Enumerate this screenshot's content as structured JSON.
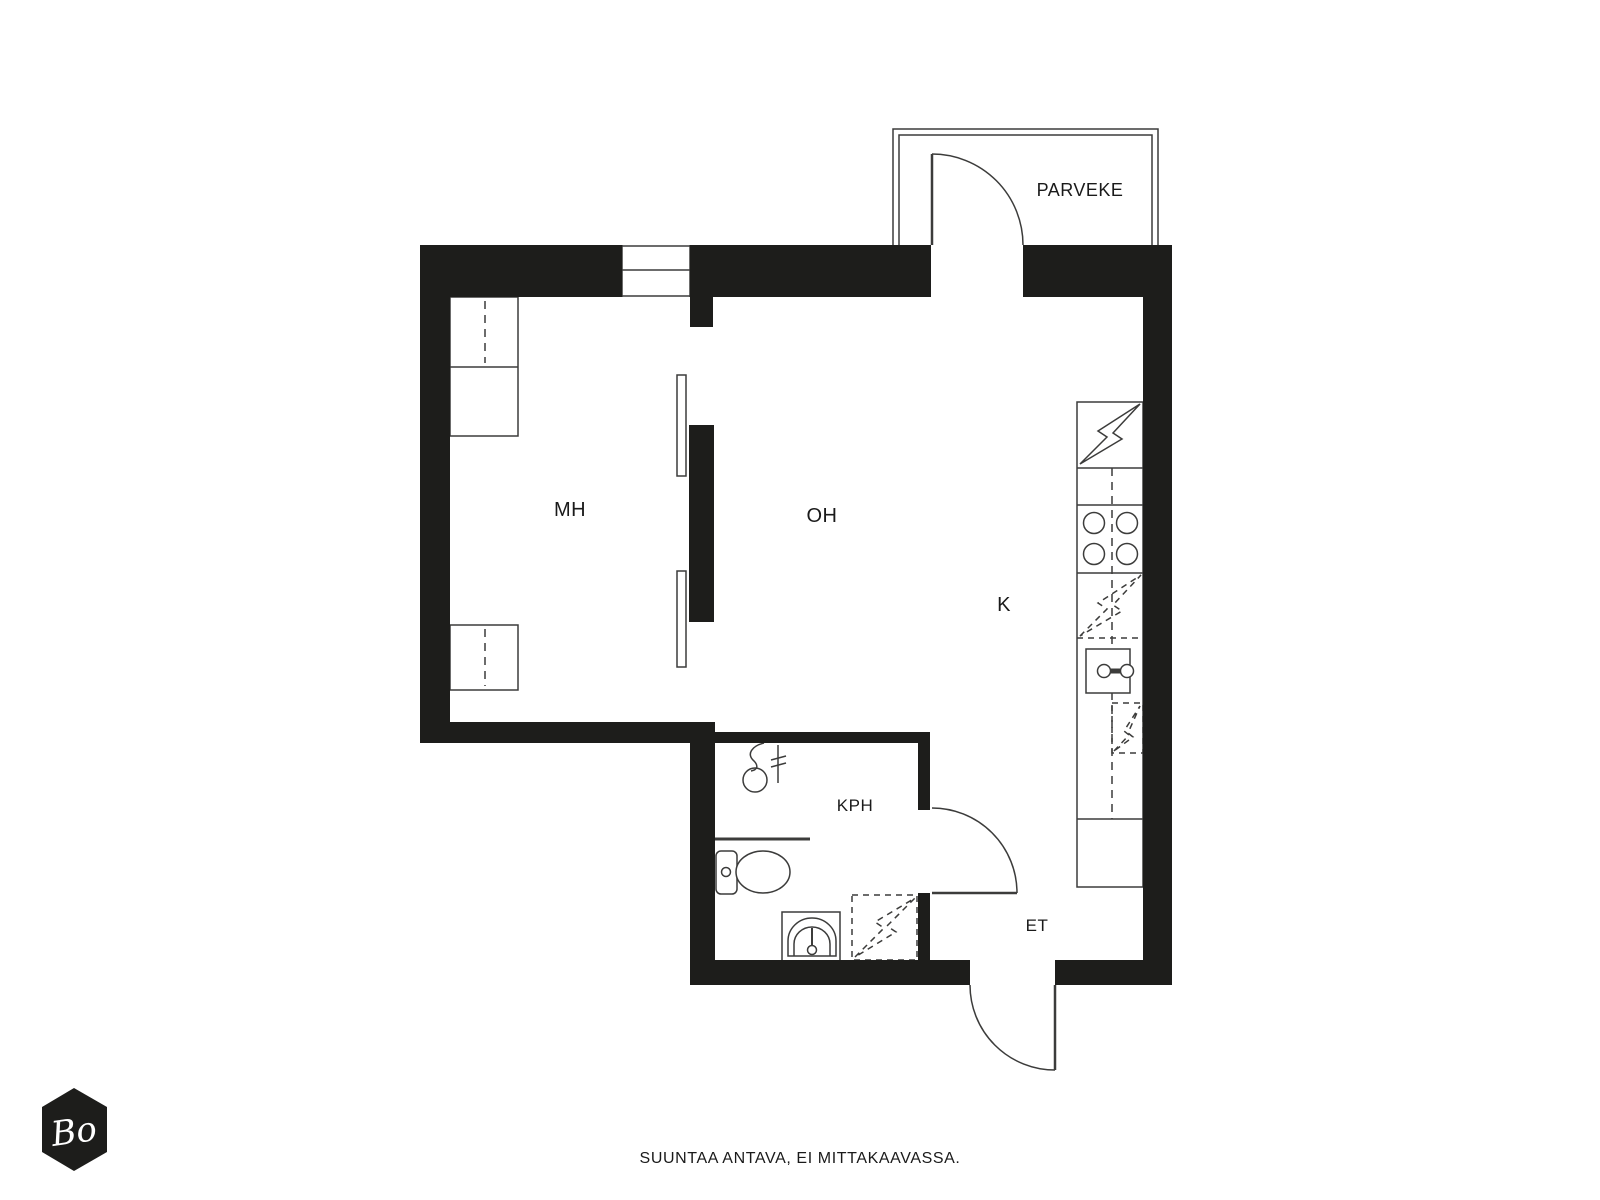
{
  "colors": {
    "wall": "#1d1d1b",
    "line": "#3c3c3b",
    "text": "#1a1a1a",
    "background": "#ffffff",
    "logo_text": "#ffffff"
  },
  "rooms": {
    "mh": "MH",
    "oh": "OH",
    "k": "K",
    "kph": "KPH",
    "et": "ET",
    "parveke": "PARVEKE"
  },
  "footer": {
    "disclaimer": "SUUNTAA ANTAVA, EI MITTAKAAVASSA."
  },
  "logo": {
    "text": "Bo"
  }
}
